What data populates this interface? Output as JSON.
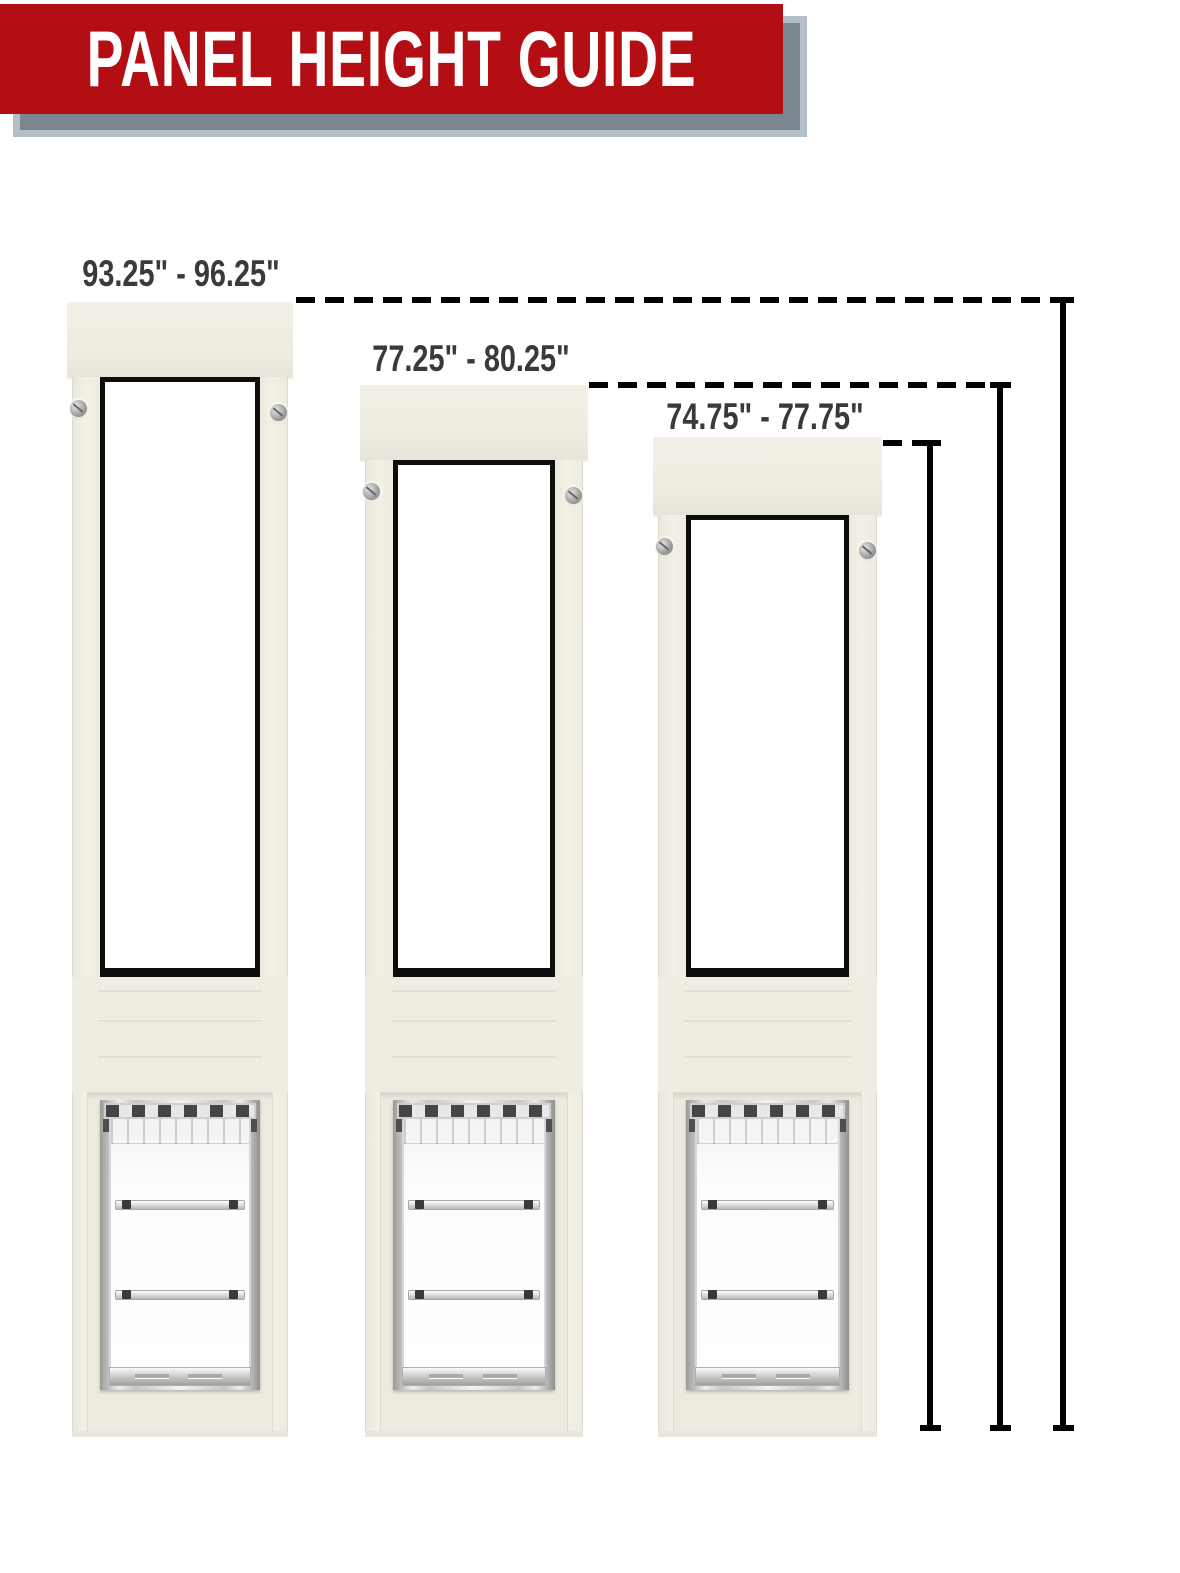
{
  "header": {
    "title": "PANEL HEIGHT GUIDE"
  },
  "panels": [
    {
      "height_range": "93.25\" - 96.25\""
    },
    {
      "height_range": "77.25\" - 80.25\""
    },
    {
      "height_range": "74.75\" - 77.75\""
    }
  ],
  "colors": {
    "banner_red": "#b30e13",
    "banner_shadow": "#7b8691",
    "banner_shadow_border": "#b5bfc9",
    "label_text": "#3a3a3c",
    "measure_line": "#000000",
    "panel_cream": "#efece2",
    "window_frame": "#0d0d0d"
  }
}
